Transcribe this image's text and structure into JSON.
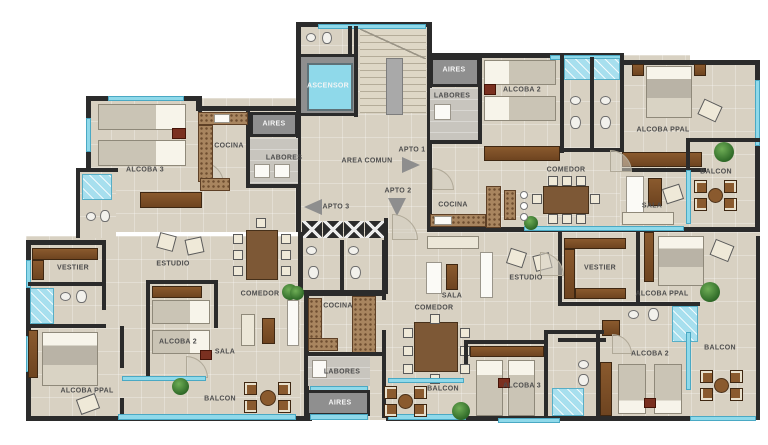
{
  "plan_title": "Apartment floor plan (3 units per level)",
  "palette": {
    "wall": "#2b2b2b",
    "floor": "#d8d1c2",
    "window_glass": "#8fd9ea",
    "shaft_gray": "#8f8f8f",
    "elevator_cab": "#8fd9ea",
    "wood": "#8a5a2e",
    "counter": "#a8855f",
    "plant_green": "#2f6a28",
    "label_dark": "#4d4d4d",
    "label_light": "#f5f5f5"
  },
  "rooms": [
    {
      "t": "ALCOBA 3",
      "x": 145,
      "y": 170
    },
    {
      "t": "COCINA",
      "x": 229,
      "y": 146
    },
    {
      "t": "AIRES",
      "x": 274,
      "y": 124
    },
    {
      "t": "LABORES",
      "x": 284,
      "y": 158
    },
    {
      "t": "ASCENSOR",
      "x": 327,
      "y": 87
    },
    {
      "t": "AREA COMUN",
      "x": 367,
      "y": 161
    },
    {
      "t": "APTO 1",
      "x": 412,
      "y": 150
    },
    {
      "t": "APTO 2",
      "x": 398,
      "y": 191
    },
    {
      "t": "APTO 3",
      "x": 336,
      "y": 207
    },
    {
      "t": "AIRES",
      "x": 454,
      "y": 70
    },
    {
      "t": "LABORES",
      "x": 452,
      "y": 114
    },
    {
      "t": "ALCOBA 2",
      "x": 522,
      "y": 90
    },
    {
      "t": "ALCOBA PPAL",
      "x": 663,
      "y": 128
    },
    {
      "t": "COMEDOR",
      "x": 566,
      "y": 173
    },
    {
      "t": "SALA",
      "x": 652,
      "y": 203
    },
    {
      "t": "BALCON",
      "x": 716,
      "y": 172
    },
    {
      "t": "COCINA",
      "x": 453,
      "y": 205
    },
    {
      "t": "VESTIER",
      "x": 73,
      "y": 264
    },
    {
      "t": "ESTUDIO",
      "x": 173,
      "y": 264
    },
    {
      "t": "COMEDOR",
      "x": 260,
      "y": 294
    },
    {
      "t": "ALCOBA 2",
      "x": 156,
      "y": 342
    },
    {
      "t": "SALA",
      "x": 225,
      "y": 337
    },
    {
      "t": "ALCOBA PPAL",
      "x": 87,
      "y": 391
    },
    {
      "t": "BALCON",
      "x": 220,
      "y": 399
    },
    {
      "t": "COCINA",
      "x": 343,
      "y": 306
    },
    {
      "t": "LABORES",
      "x": 336,
      "y": 377
    },
    {
      "t": "AIRES",
      "x": 340,
      "y": 403
    },
    {
      "t": "SALA",
      "x": 452,
      "y": 293
    },
    {
      "t": "ESTUDIO",
      "x": 526,
      "y": 278
    },
    {
      "t": "VESTIER",
      "x": 588,
      "y": 268
    },
    {
      "t": "ALCOBA PPAL",
      "x": 662,
      "y": 293
    },
    {
      "t": "COMEDOR",
      "x": 434,
      "y": 310
    },
    {
      "t": "ALCOBA 2",
      "x": 652,
      "y": 356
    },
    {
      "t": "ALCOBA 3",
      "x": 524,
      "y": 385
    },
    {
      "t": "BALCON",
      "x": 716,
      "y": 348
    },
    {
      "t": "BALCON",
      "x": 443,
      "y": 389
    }
  ]
}
